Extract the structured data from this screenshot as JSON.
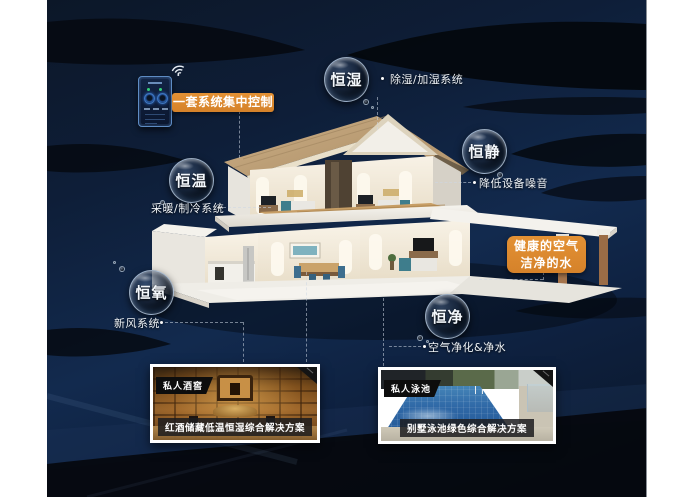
{
  "control_label": "一套系统集中控制",
  "bubbles": [
    {
      "label": "恒湿",
      "desc": "除湿/加湿系统"
    },
    {
      "label": "恒静",
      "desc": "降低设备噪音"
    },
    {
      "label": "恒温",
      "desc": "采暖/制冷系统"
    },
    {
      "label": "恒氧",
      "desc": "新风系统"
    },
    {
      "label": "恒净",
      "desc": "空气净化&净水"
    }
  ],
  "highlight": {
    "line1": "健康的空气",
    "line2": "洁净的水"
  },
  "photos": {
    "wine": {
      "badge": "私人酒窖",
      "caption": "红酒储藏低温恒湿综合解决方案"
    },
    "pool": {
      "badge": "私人泳池",
      "caption": "别墅泳池绿色综合解决方案"
    }
  },
  "icons": {
    "wifi": "wifi-icon",
    "controller": "smart-home-controller"
  },
  "colors": {
    "accent_orange": "#dd8a2f",
    "bg_navy": "#0e1e38",
    "swoosh_black": "#05090f",
    "text": "#ffffff"
  }
}
